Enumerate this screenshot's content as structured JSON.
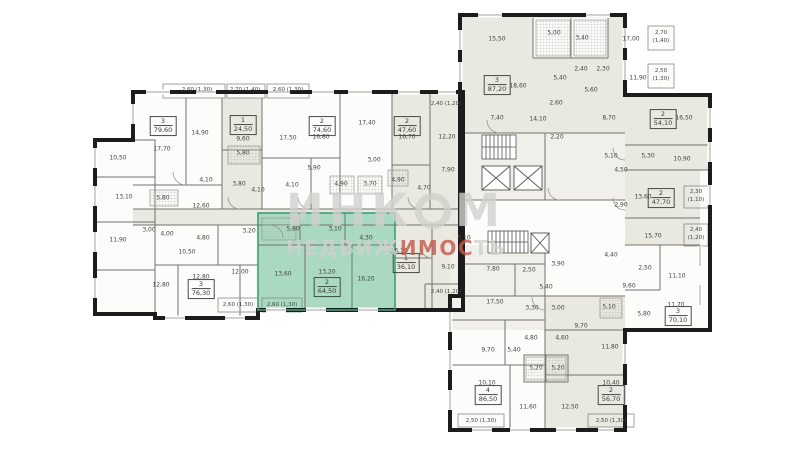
{
  "colors": {
    "highlight": "#a9d9c0",
    "highlight_border": "#3f9e74",
    "watermark_red": "#c9574a",
    "wall": "#1c1c1c",
    "room_gray": "#e9e8e1"
  },
  "watermark": {
    "brand_prefix": "ИНК",
    "brand_suffix": "М",
    "sub_gray1": "НЕДВИЖ",
    "sub_red": "ИМОС",
    "sub_gray2": "ТЬ"
  },
  "apartments": [
    {
      "number": "3",
      "area": "79,60",
      "x": 163,
      "y": 126
    },
    {
      "number": "1",
      "area": "24,50",
      "x": 243,
      "y": 125
    },
    {
      "number": "2",
      "area": "74,60",
      "x": 322,
      "y": 126
    },
    {
      "number": "2",
      "area": "47,60",
      "x": 407,
      "y": 126
    },
    {
      "number": "3",
      "area": "87,20",
      "x": 497,
      "y": 85
    },
    {
      "number": "2",
      "area": "54,10",
      "x": 663,
      "y": 119
    },
    {
      "number": "2",
      "area": "47,70",
      "x": 661,
      "y": 198
    },
    {
      "number": "3",
      "area": "70,10",
      "x": 678,
      "y": 316
    },
    {
      "number": "2",
      "area": "56,70",
      "x": 611,
      "y": 395
    },
    {
      "number": "4",
      "area": "86,50",
      "x": 488,
      "y": 395
    },
    {
      "number": "1",
      "area": "36,10",
      "x": 406,
      "y": 263
    },
    {
      "number": "3",
      "area": "76,30",
      "x": 201,
      "y": 289
    },
    {
      "number": "2",
      "area": "64,50",
      "x": 327,
      "y": 287,
      "cls": "hl"
    }
  ],
  "room_labels": [
    {
      "text": "10,50",
      "x": 118,
      "y": 158
    },
    {
      "text": "13,10",
      "x": 124,
      "y": 197
    },
    {
      "text": "11,90",
      "x": 118,
      "y": 240
    },
    {
      "text": "12,80",
      "x": 161,
      "y": 285
    },
    {
      "text": "17,70",
      "x": 162,
      "y": 149
    },
    {
      "text": "14,90",
      "x": 200,
      "y": 133
    },
    {
      "text": "5,80",
      "x": 163,
      "y": 198
    },
    {
      "text": "12,60",
      "x": 201,
      "y": 206
    },
    {
      "text": "4,10",
      "x": 206,
      "y": 180
    },
    {
      "text": "9,60",
      "x": 243,
      "y": 139
    },
    {
      "text": "5,80",
      "x": 243,
      "y": 153
    },
    {
      "text": "3,80",
      "x": 239,
      "y": 184
    },
    {
      "text": "4,10",
      "x": 258,
      "y": 190
    },
    {
      "text": "17,50",
      "x": 288,
      "y": 138
    },
    {
      "text": "16,80",
      "x": 321,
      "y": 137
    },
    {
      "text": "17,40",
      "x": 367,
      "y": 123
    },
    {
      "text": "5,90",
      "x": 314,
      "y": 168
    },
    {
      "text": "4,90",
      "x": 341,
      "y": 184
    },
    {
      "text": "3,00",
      "x": 374,
      "y": 160
    },
    {
      "text": "3,70",
      "x": 370,
      "y": 184
    },
    {
      "text": "4,10",
      "x": 292,
      "y": 185
    },
    {
      "text": "16,70",
      "x": 407,
      "y": 137
    },
    {
      "text": "4,90",
      "x": 398,
      "y": 180
    },
    {
      "text": "4,70",
      "x": 424,
      "y": 188
    },
    {
      "text": "12,20",
      "x": 447,
      "y": 137
    },
    {
      "text": "7,90",
      "x": 448,
      "y": 170
    },
    {
      "text": "3,00",
      "x": 149,
      "y": 230
    },
    {
      "text": "4,00",
      "x": 167,
      "y": 234
    },
    {
      "text": "4,80",
      "x": 203,
      "y": 238
    },
    {
      "text": "10,50",
      "x": 187,
      "y": 252
    },
    {
      "text": "12,80",
      "x": 201,
      "y": 277
    },
    {
      "text": "12,00",
      "x": 240,
      "y": 272
    },
    {
      "text": "3,20",
      "x": 249,
      "y": 231
    },
    {
      "text": "5,80",
      "x": 293,
      "y": 229
    },
    {
      "text": "3,10",
      "x": 335,
      "y": 229
    },
    {
      "text": "4,30",
      "x": 366,
      "y": 238
    },
    {
      "text": "13,60",
      "x": 283,
      "y": 274
    },
    {
      "text": "13,20",
      "x": 327,
      "y": 272
    },
    {
      "text": "16,20",
      "x": 366,
      "y": 279
    },
    {
      "text": "16,15",
      "x": 399,
      "y": 251
    },
    {
      "text": "9,10",
      "x": 448,
      "y": 267
    },
    {
      "text": "5,10",
      "x": 464,
      "y": 238
    },
    {
      "text": "15,50",
      "x": 497,
      "y": 39
    },
    {
      "text": "5,00",
      "x": 554,
      "y": 33
    },
    {
      "text": "3,40",
      "x": 582,
      "y": 38
    },
    {
      "text": "17,00",
      "x": 631,
      "y": 39
    },
    {
      "text": "18,60",
      "x": 518,
      "y": 86
    },
    {
      "text": "7,40",
      "x": 497,
      "y": 118
    },
    {
      "text": "14,10",
      "x": 538,
      "y": 119
    },
    {
      "text": "2,60",
      "x": 556,
      "y": 103
    },
    {
      "text": "2,20",
      "x": 557,
      "y": 137
    },
    {
      "text": "5,40",
      "x": 560,
      "y": 78
    },
    {
      "text": "2,40",
      "x": 581,
      "y": 69
    },
    {
      "text": "2,30",
      "x": 603,
      "y": 69
    },
    {
      "text": "11,90",
      "x": 638,
      "y": 78
    },
    {
      "text": "5,60",
      "x": 591,
      "y": 90
    },
    {
      "text": "8,70",
      "x": 609,
      "y": 118
    },
    {
      "text": "16,50",
      "x": 684,
      "y": 118
    },
    {
      "text": "5,10",
      "x": 611,
      "y": 156
    },
    {
      "text": "5,30",
      "x": 648,
      "y": 156
    },
    {
      "text": "10,90",
      "x": 682,
      "y": 159
    },
    {
      "text": "4,50",
      "x": 621,
      "y": 170
    },
    {
      "text": "13,60",
      "x": 643,
      "y": 197
    },
    {
      "text": "2,90",
      "x": 621,
      "y": 205
    },
    {
      "text": "15,70",
      "x": 653,
      "y": 236
    },
    {
      "text": "4,40",
      "x": 611,
      "y": 255
    },
    {
      "text": "2,50",
      "x": 645,
      "y": 268
    },
    {
      "text": "11,10",
      "x": 677,
      "y": 276
    },
    {
      "text": "9,60",
      "x": 629,
      "y": 286
    },
    {
      "text": "5,10",
      "x": 609,
      "y": 307
    },
    {
      "text": "5,80",
      "x": 644,
      "y": 314
    },
    {
      "text": "11,70",
      "x": 676,
      "y": 305
    },
    {
      "text": "7,80",
      "x": 493,
      "y": 269
    },
    {
      "text": "2,50",
      "x": 529,
      "y": 270
    },
    {
      "text": "3,90",
      "x": 558,
      "y": 264
    },
    {
      "text": "5,40",
      "x": 546,
      "y": 287
    },
    {
      "text": "17,50",
      "x": 495,
      "y": 302
    },
    {
      "text": "3,30",
      "x": 532,
      "y": 308
    },
    {
      "text": "3,00",
      "x": 558,
      "y": 308
    },
    {
      "text": "9,70",
      "x": 581,
      "y": 326
    },
    {
      "text": "4,80",
      "x": 531,
      "y": 338
    },
    {
      "text": "4,60",
      "x": 562,
      "y": 338
    },
    {
      "text": "11,80",
      "x": 610,
      "y": 347
    },
    {
      "text": "9,70",
      "x": 488,
      "y": 350
    },
    {
      "text": "5,40",
      "x": 514,
      "y": 350
    },
    {
      "text": "5,20",
      "x": 536,
      "y": 368
    },
    {
      "text": "5,20",
      "x": 558,
      "y": 368
    },
    {
      "text": "10,10",
      "x": 487,
      "y": 383
    },
    {
      "text": "10,40",
      "x": 611,
      "y": 383
    },
    {
      "text": "11,60",
      "x": 528,
      "y": 407
    },
    {
      "text": "12,50",
      "x": 570,
      "y": 407
    }
  ],
  "dim_labels": [
    {
      "text": "2,60 (1,30)",
      "x": 197,
      "y": 90
    },
    {
      "text": "2,70 (1,40)",
      "x": 245,
      "y": 90
    },
    {
      "text": "2,60 (1,30)",
      "x": 288,
      "y": 90
    },
    {
      "text": "2,40 (1,20)",
      "x": 446,
      "y": 104
    },
    {
      "text": "2,70",
      "x": 661,
      "y": 33
    },
    {
      "text": "(1,40)",
      "x": 661,
      "y": 41
    },
    {
      "text": "2,50",
      "x": 661,
      "y": 71
    },
    {
      "text": "(1,30)",
      "x": 661,
      "y": 79
    },
    {
      "text": "2,30",
      "x": 696,
      "y": 192
    },
    {
      "text": "(1,10)",
      "x": 696,
      "y": 200
    },
    {
      "text": "2,40",
      "x": 696,
      "y": 230
    },
    {
      "text": "(1,20)",
      "x": 696,
      "y": 238
    },
    {
      "text": "2,60 (1,30)",
      "x": 238,
      "y": 305
    },
    {
      "text": "2,60 (1,30)",
      "x": 282,
      "y": 305
    },
    {
      "text": "2,40 (1,20)",
      "x": 446,
      "y": 292
    },
    {
      "text": "2,50 (1,30)",
      "x": 481,
      "y": 421
    },
    {
      "text": "2,50 (1,30)",
      "x": 611,
      "y": 421
    }
  ]
}
